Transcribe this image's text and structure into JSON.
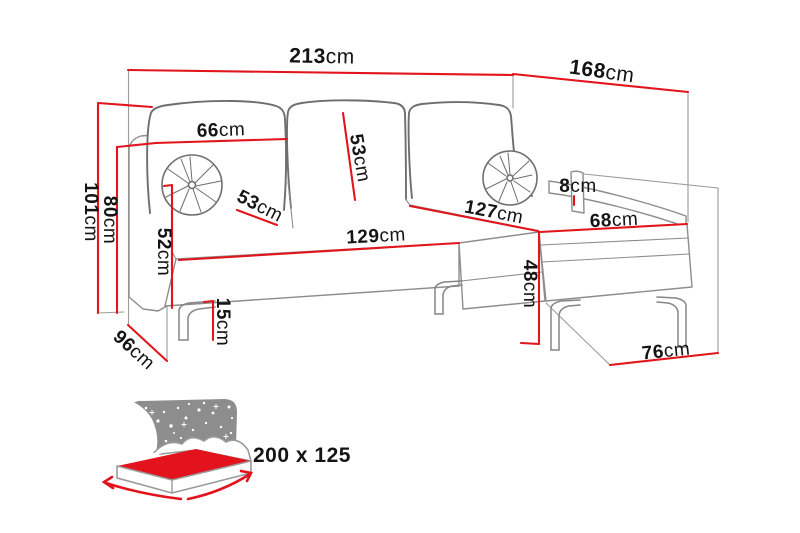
{
  "diagram_title": "corner-sofa-dimensions",
  "colors": {
    "dimension_red": "#e2151c",
    "outline_gray": "#8d8d8d",
    "cushion_gray": "#6e6e6e",
    "icon_gray": "#8d8d8d",
    "mattress_red": "#e2131c",
    "text_black": "#141414",
    "background": "#ffffff"
  },
  "dimensions": {
    "total_width": {
      "value": "213",
      "unit": "cm"
    },
    "chaise_length": {
      "value": "168",
      "unit": "cm"
    },
    "backrest_width": {
      "value": "66",
      "unit": "cm"
    },
    "back_cushion_height": {
      "value": "53",
      "unit": "cm"
    },
    "seat_cushion_depth": {
      "value": "53",
      "unit": "cm"
    },
    "total_height": {
      "value": "101",
      "unit": "cm"
    },
    "armrest_height": {
      "value": "80",
      "unit": "cm"
    },
    "armrest_panel_height": {
      "value": "52",
      "unit": "cm"
    },
    "leg_height": {
      "value": "15",
      "unit": "cm"
    },
    "depth_floor": {
      "value": "96",
      "unit": "cm"
    },
    "seat_front_width": {
      "value": "129",
      "unit": "cm"
    },
    "chaise_seat_length": {
      "value": "127",
      "unit": "cm"
    },
    "chaise_seat_width": {
      "value": "68",
      "unit": "cm"
    },
    "chaise_base_height": {
      "value": "48",
      "unit": "cm"
    },
    "side_lip_height": {
      "value": "8",
      "unit": "cm"
    },
    "chaise_floor_width": {
      "value": "76",
      "unit": "cm"
    }
  },
  "sleeping_area": {
    "size_label": "200 x 125"
  }
}
